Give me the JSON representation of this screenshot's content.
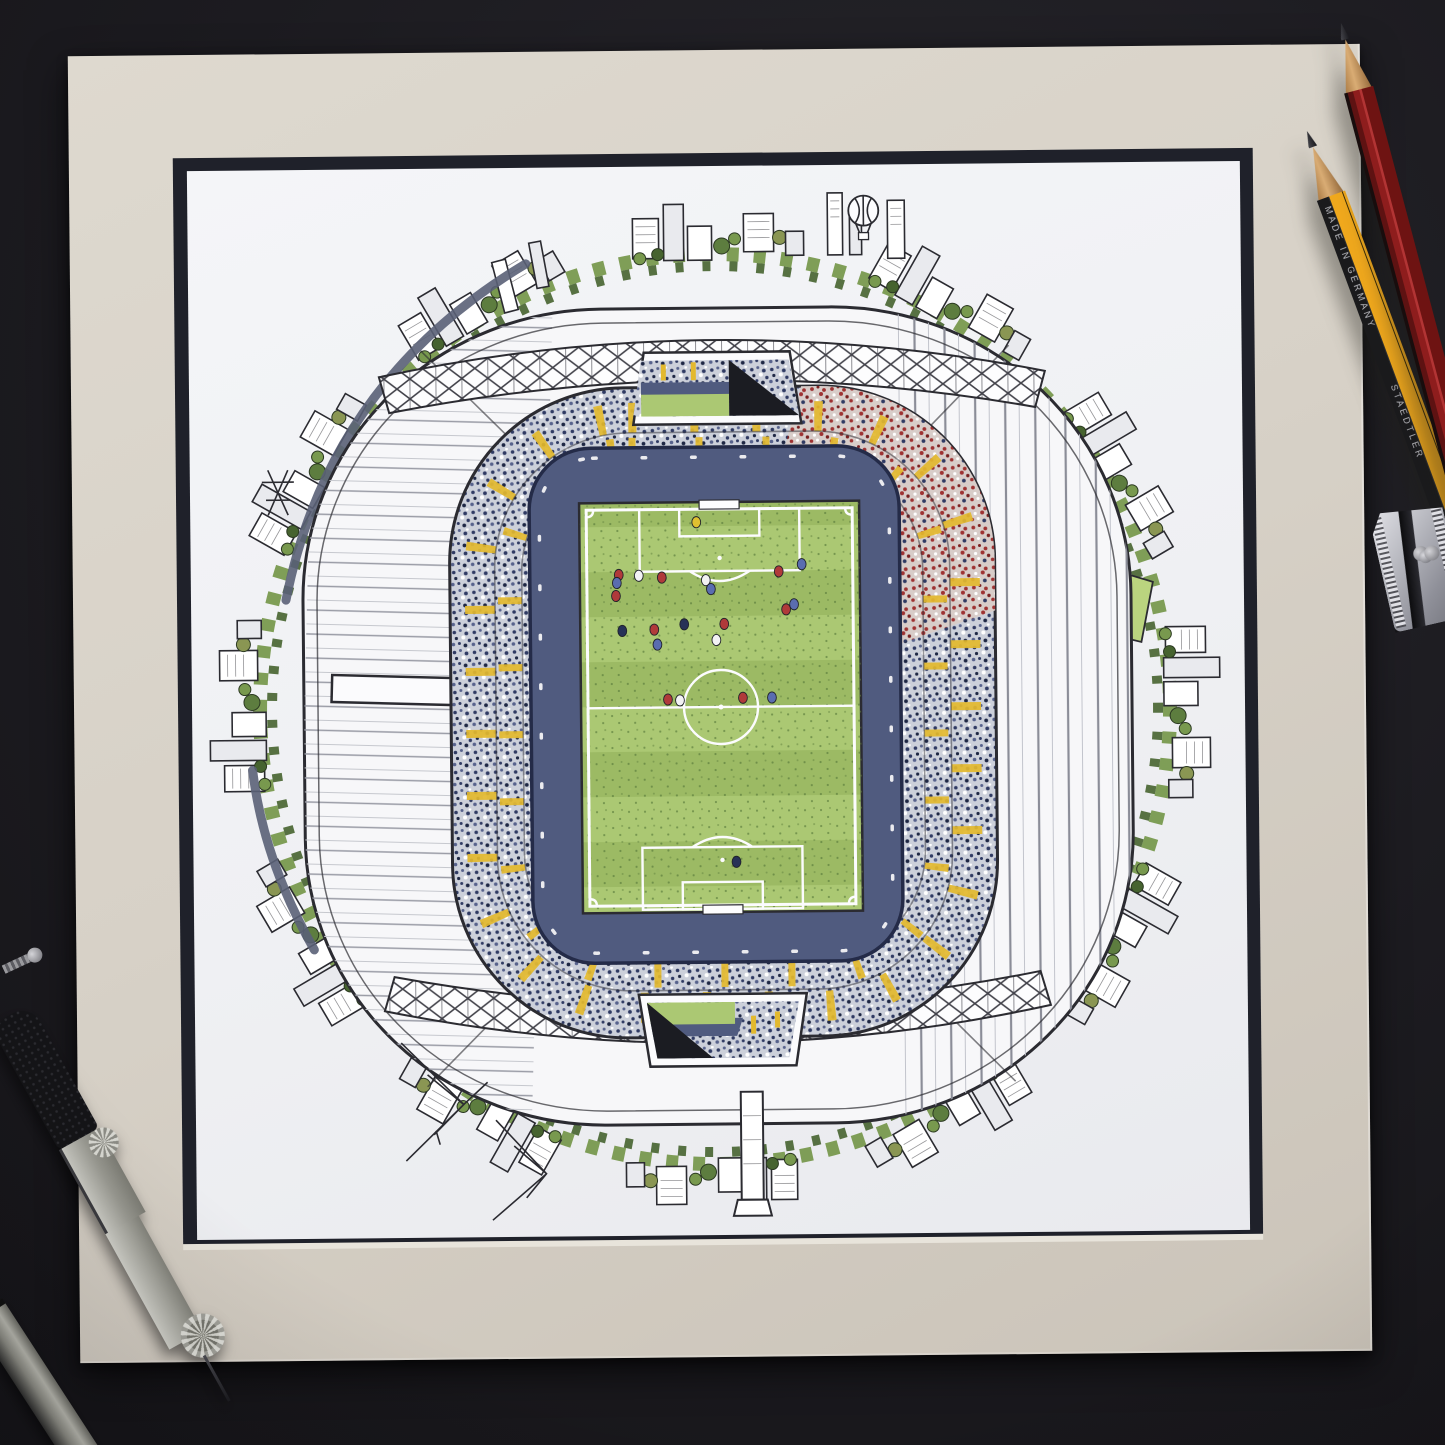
{
  "pencils": {
    "yellow": {
      "brand_text": "STAEDTLER",
      "origin_text": "MADE IN GERMANY"
    },
    "red": {}
  },
  "colors": {
    "mat": "#d7d1c7",
    "matLight": "#ded9cf",
    "matDark": "#cbc4b9",
    "windowCore": "#1f212a",
    "bevelLight": "#e8e4db",
    "ink": "#2b2b31",
    "roofWhite": "#f7f7f9",
    "grassLight": "#abc873",
    "grassDark": "#9cba64",
    "parkGreen": "#bad47f",
    "walkway": "#505b7f",
    "walkwayDark": "#242b48",
    "crowdBase": "#ccd0da",
    "crowdNavy": "#2f3a63",
    "crowdNavy2": "#57628c",
    "crowdDark": "#1e2744",
    "redCrowd": "#9e3232",
    "redCrowdBase": "#d8cdc9",
    "aisleYellow": "#e3b92e",
    "treeGreen1": "#5d7d3f",
    "treeGreen2": "#78994e",
    "treeGreen3": "#46632f",
    "treeOlive": "#8a9653",
    "roadNavy": "#5a6177",
    "pencilYellow": "#f0a81c",
    "pencilBlack": "#1a1a1c",
    "pencilRed": "#8e1d1d",
    "pencilRedLight": "#b23434",
    "pencilRedDark": "#5e1212",
    "playerRed": "#b03a3a",
    "playerWhite": "#f2f2f4",
    "playerBlue": "#5a6db0",
    "playerNavy": "#273257",
    "playerYellow": "#e0c030"
  },
  "illustration": {
    "balloon": {
      "x": 676,
      "y": 46
    },
    "players": [
      {
        "x": 506,
        "y": 356,
        "c": "yellow"
      },
      {
        "x": 428,
        "y": 408,
        "c": "red"
      },
      {
        "x": 448,
        "y": 409,
        "c": "white"
      },
      {
        "x": 471,
        "y": 411,
        "c": "red"
      },
      {
        "x": 426,
        "y": 416,
        "c": "blue"
      },
      {
        "x": 425,
        "y": 429,
        "c": "red"
      },
      {
        "x": 515,
        "y": 414,
        "c": "white"
      },
      {
        "x": 520,
        "y": 423,
        "c": "blue"
      },
      {
        "x": 588,
        "y": 406,
        "c": "red"
      },
      {
        "x": 611,
        "y": 399,
        "c": "blue"
      },
      {
        "x": 595,
        "y": 444,
        "c": "red"
      },
      {
        "x": 603,
        "y": 439,
        "c": "blue"
      },
      {
        "x": 493,
        "y": 458,
        "c": "navy"
      },
      {
        "x": 463,
        "y": 463,
        "c": "red"
      },
      {
        "x": 466,
        "y": 478,
        "c": "blue"
      },
      {
        "x": 533,
        "y": 458,
        "c": "red"
      },
      {
        "x": 525,
        "y": 474,
        "c": "white"
      },
      {
        "x": 431,
        "y": 464,
        "c": "navy"
      },
      {
        "x": 476,
        "y": 533,
        "c": "red"
      },
      {
        "x": 488,
        "y": 534,
        "c": "white"
      },
      {
        "x": 551,
        "y": 532,
        "c": "red"
      },
      {
        "x": 580,
        "y": 532,
        "c": "blue"
      },
      {
        "x": 543,
        "y": 696,
        "c": "navy"
      }
    ]
  }
}
